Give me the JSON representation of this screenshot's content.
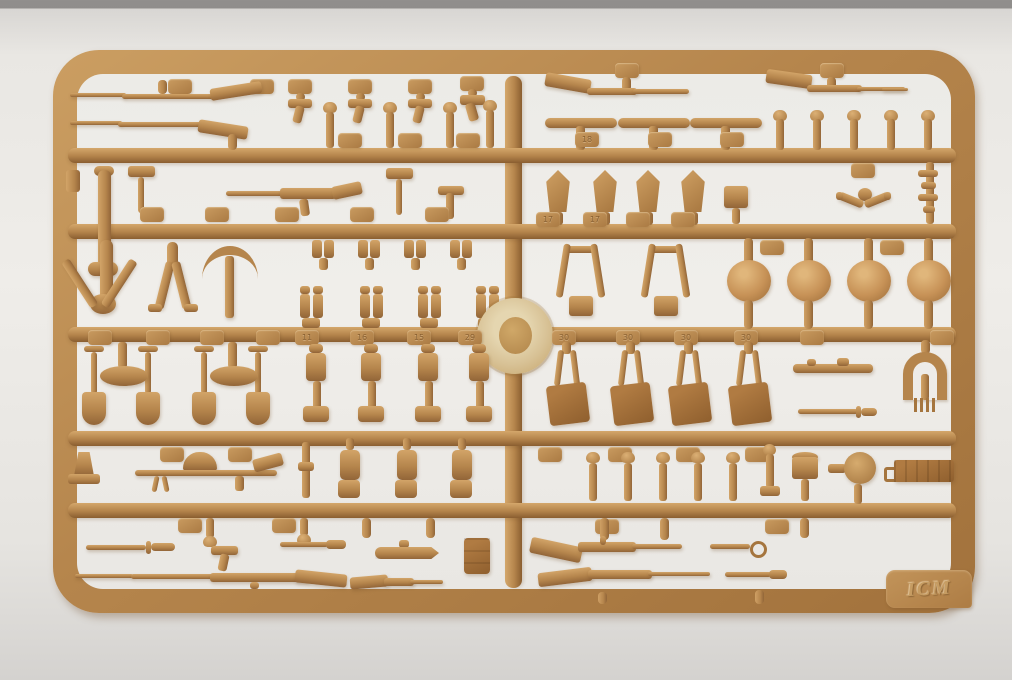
{
  "scene": {
    "type": "photograph",
    "subject": "Tan plastic injection-molded model-kit sprue holding WWI infantry weapons and equipment parts",
    "background": "off-white studio backdrop with gray strip at top edge"
  },
  "colors": {
    "plastic_base": "#b5854c",
    "plastic_highlight": "#d4a76b",
    "plastic_shadow": "#8a5e30",
    "dark_parts": "#9c6a35",
    "gate_disc": "#dbc89e",
    "backdrop": "#eceae6",
    "backdrop_top_strip": "#8f8d8b"
  },
  "branding": {
    "logo_text": "ICM"
  },
  "part_numbers": {
    "pouch": "11",
    "flask": "15",
    "mess_tin": "16",
    "helmet_cover": "17",
    "scabbard": "18",
    "canteen": "29",
    "backpack": "30"
  },
  "parts_inventory": [
    {
      "name": "rifle with fixed bayonet",
      "count": 6
    },
    {
      "name": "pistol",
      "count": 5
    },
    {
      "name": "domed helmet",
      "count": 4
    },
    {
      "name": "covered helmet",
      "count": 4
    },
    {
      "name": "entrenching shovel",
      "count": 4
    },
    {
      "name": "backpack",
      "count": 4
    },
    {
      "name": "bayonet or scabbard",
      "count": 6
    },
    {
      "name": "machine gun with drum magazine",
      "count": 1
    },
    {
      "name": "pickaxe",
      "count": 1
    },
    {
      "name": "hand axe",
      "count": 2
    },
    {
      "name": "bipod frame",
      "count": 1
    },
    {
      "name": "canteen / mess tin set",
      "count": 10
    },
    {
      "name": "stick grenade / small fitting",
      "count": 14
    },
    {
      "name": "ammunition box",
      "count": 1
    },
    {
      "name": "drum magazine",
      "count": 1
    }
  ]
}
